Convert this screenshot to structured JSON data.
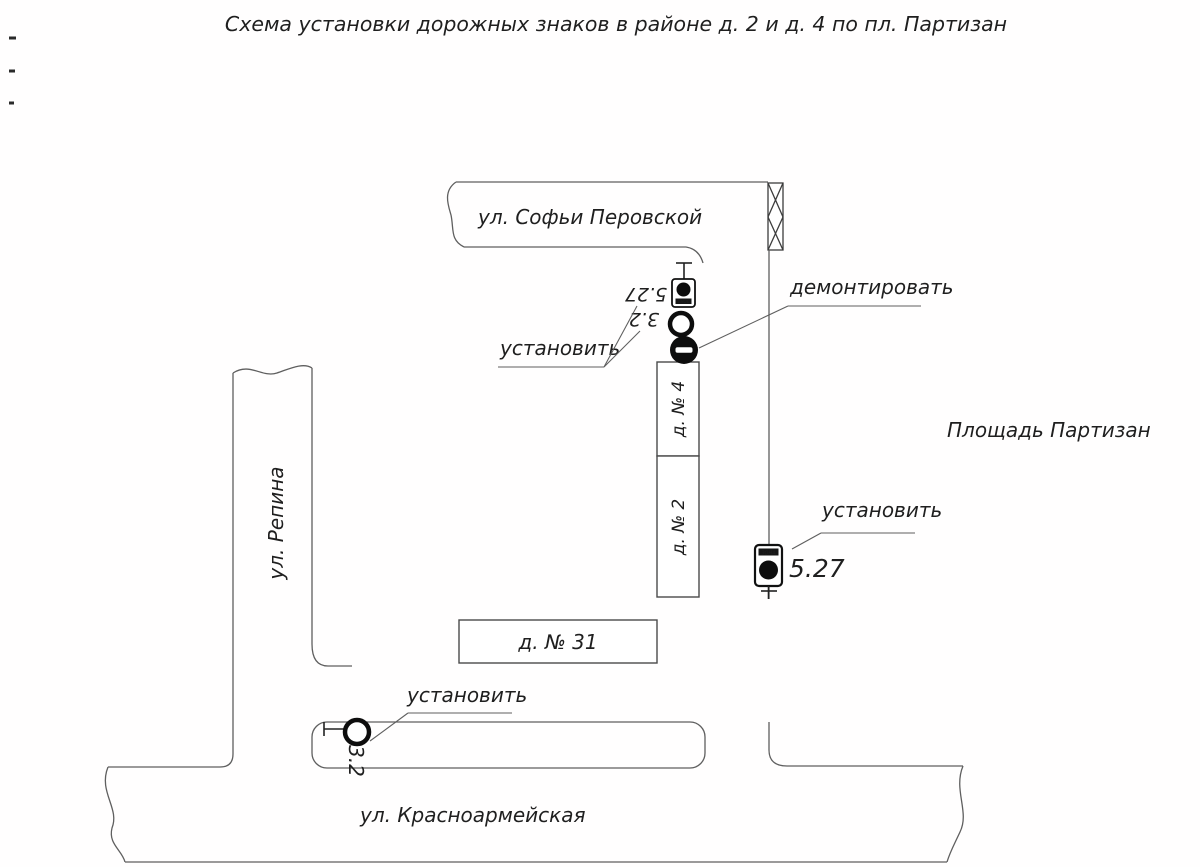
{
  "title": "Схема установки дорожных знаков в районе д. 2 и д. 4 по пл. Партизан",
  "streets": {
    "sofia_perovskoy": "ул. Софьи Перовской",
    "repina": "ул. Репина",
    "krasnoarmeyskaya": "ул. Красноармейская"
  },
  "square": {
    "label": "Площадь Партизан"
  },
  "buildings": {
    "b4": "д. № 4",
    "b2": "д. № 2",
    "b31": "д. № 31"
  },
  "annotations": {
    "install": "установить",
    "dismantle": "демонтировать"
  },
  "signs": {
    "top_527_code": "5.27",
    "top_32_code": "3.2",
    "right_527_code": "5.27",
    "bottom_32_code": "3.2",
    "zone_banner": "ЗОНА"
  }
}
